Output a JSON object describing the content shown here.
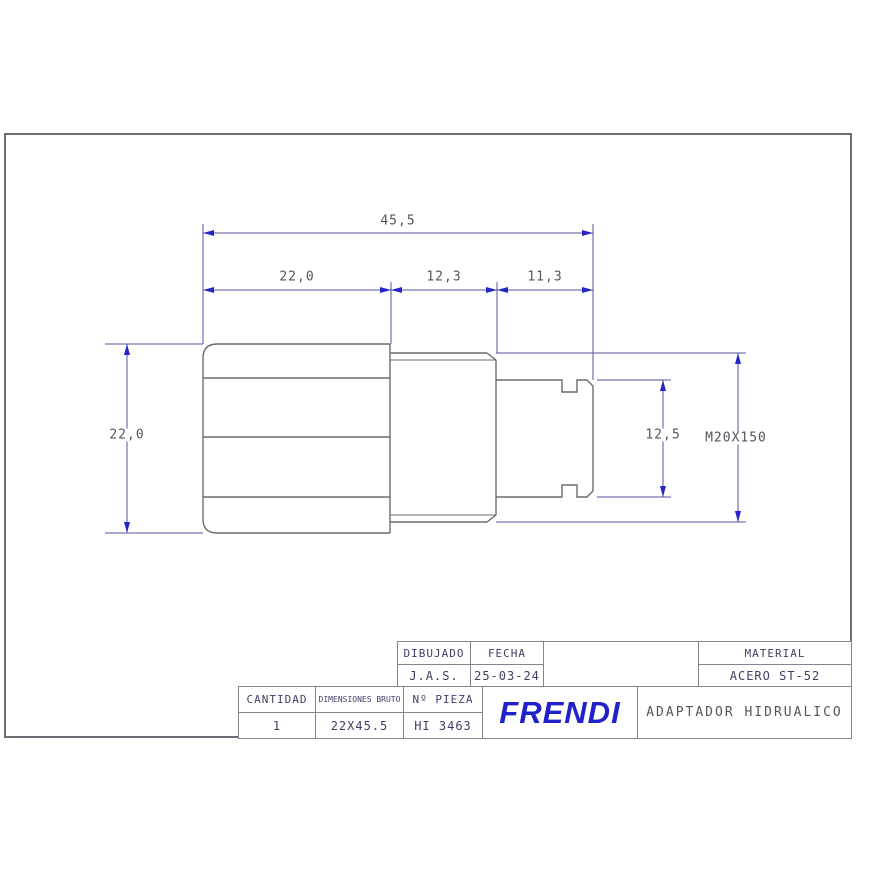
{
  "drawing": {
    "dimensions": {
      "total_length": "45,5",
      "hex_length": "22,0",
      "thread_length": "12,3",
      "pilot_length": "11,3",
      "hex_width": "22,0",
      "pilot_diameter": "12,5",
      "thread_spec": "M20X150"
    }
  },
  "title_block": {
    "dibujado_label": "DIBUJADO",
    "fecha_label": "FECHA",
    "dibujado_value": "J.A.S.",
    "fecha_value": "25-03-24",
    "material_label": "MATERIAL",
    "material_value": "ACERO ST-52",
    "cantidad_label": "CANTIDAD",
    "cantidad_value": "1",
    "dimensiones_label": "DIMENSIONES BRUTO",
    "dimensiones_value": "22X45.5",
    "pieza_label": "Nº PIEZA",
    "pieza_value": "HI 3463",
    "company": "FRENDI",
    "part_title": "ADAPTADOR HIDRUALICO"
  },
  "colors": {
    "part_line": "#6b6b73",
    "dimension_line": "#5656a2",
    "arrow": "#2525c8",
    "text": "#54545c",
    "brand": "#2121cc"
  }
}
